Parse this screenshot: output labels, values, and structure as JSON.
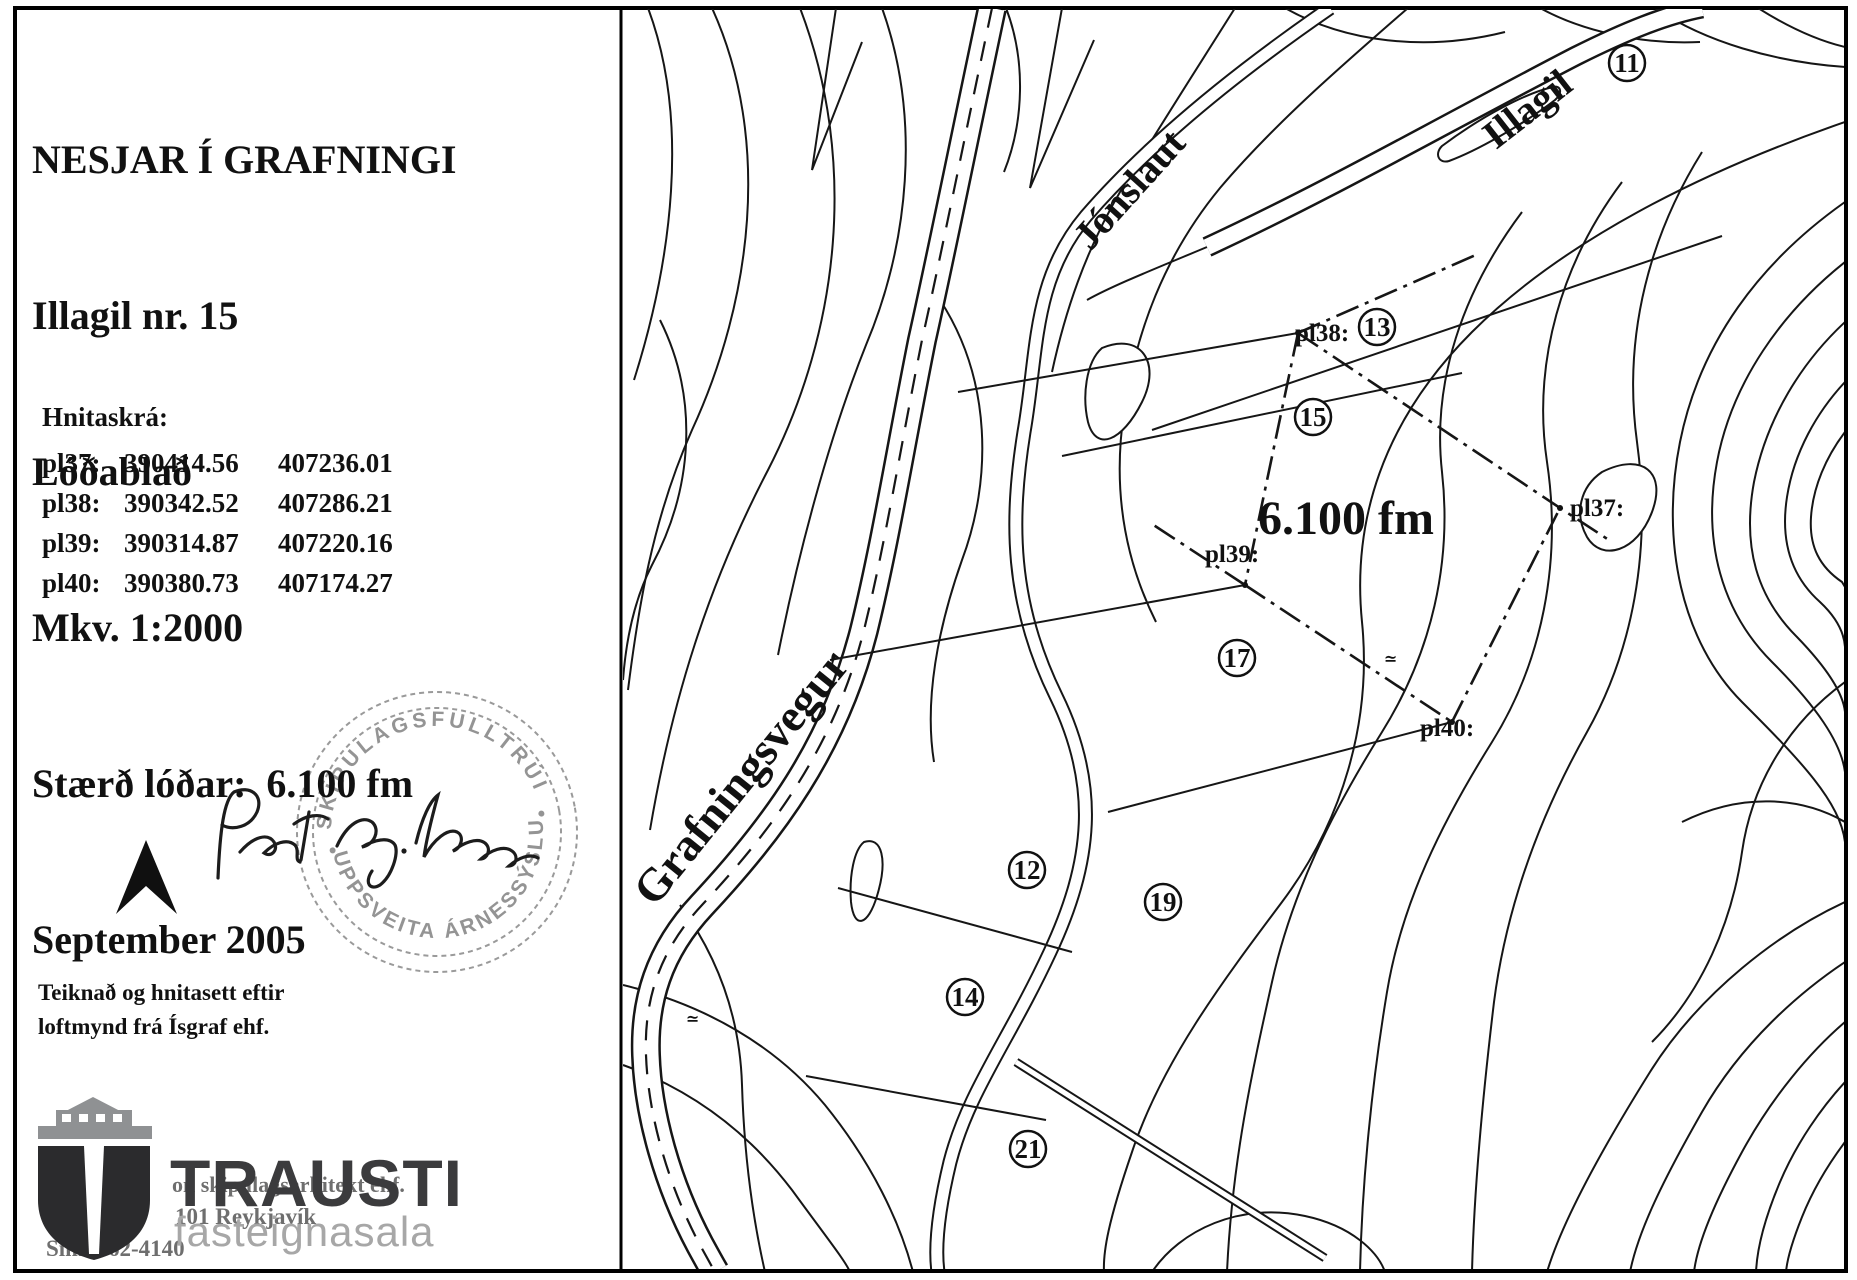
{
  "sheet": {
    "title": "NESJAR Í GRAFNINGI",
    "subtitle": "Illagil nr. 15",
    "doc_type": "Lóðablað",
    "scale": "Mkv. 1:2000",
    "lot_size": "Stærð lóðar:  6.100 fm",
    "date": "September 2005"
  },
  "coordinate_table": {
    "heading": "Hnitaskrá:",
    "rows": [
      {
        "id": "pl37:",
        "x": "390414.56",
        "y": "407236.01"
      },
      {
        "id": "pl38:",
        "x": "390342.52",
        "y": "407286.21"
      },
      {
        "id": "pl39:",
        "x": "390314.87",
        "y": "407220.16"
      },
      {
        "id": "pl40:",
        "x": "390380.73",
        "y": "407174.27"
      }
    ]
  },
  "stamp": {
    "top": "SKIPULAGSFULLTRÚI",
    "bottom": "UPPSVEITA ÁRNESSÝSLU"
  },
  "signature": "Pétur Ing. Haraldsson",
  "credit": {
    "line1": "Teiknað og hnitasett eftir",
    "line2": "loftmynd frá Ísgraf ehf."
  },
  "agency": {
    "name": "TRAUSTI",
    "tagline": "fasteignasala",
    "background_text": {
      "line1": "on skipulagsarkitekt ehf.",
      "line2": "101 Reykjavík",
      "line3": "Sími 562-4140"
    }
  },
  "map": {
    "road": "Grafningsvegur",
    "stream": "Jónslaut",
    "gorge": "Illagil",
    "area": "6.100 fm",
    "plots": [
      {
        "num": "11"
      },
      {
        "num": "13"
      },
      {
        "num": "15"
      },
      {
        "num": "17"
      },
      {
        "num": "12"
      },
      {
        "num": "19"
      },
      {
        "num": "14"
      },
      {
        "num": "21"
      }
    ],
    "points": [
      {
        "label": "pl37:"
      },
      {
        "label": "pl38:"
      },
      {
        "label": "pl39:"
      },
      {
        "label": "pl40:"
      }
    ],
    "misc_mark": "≃"
  }
}
